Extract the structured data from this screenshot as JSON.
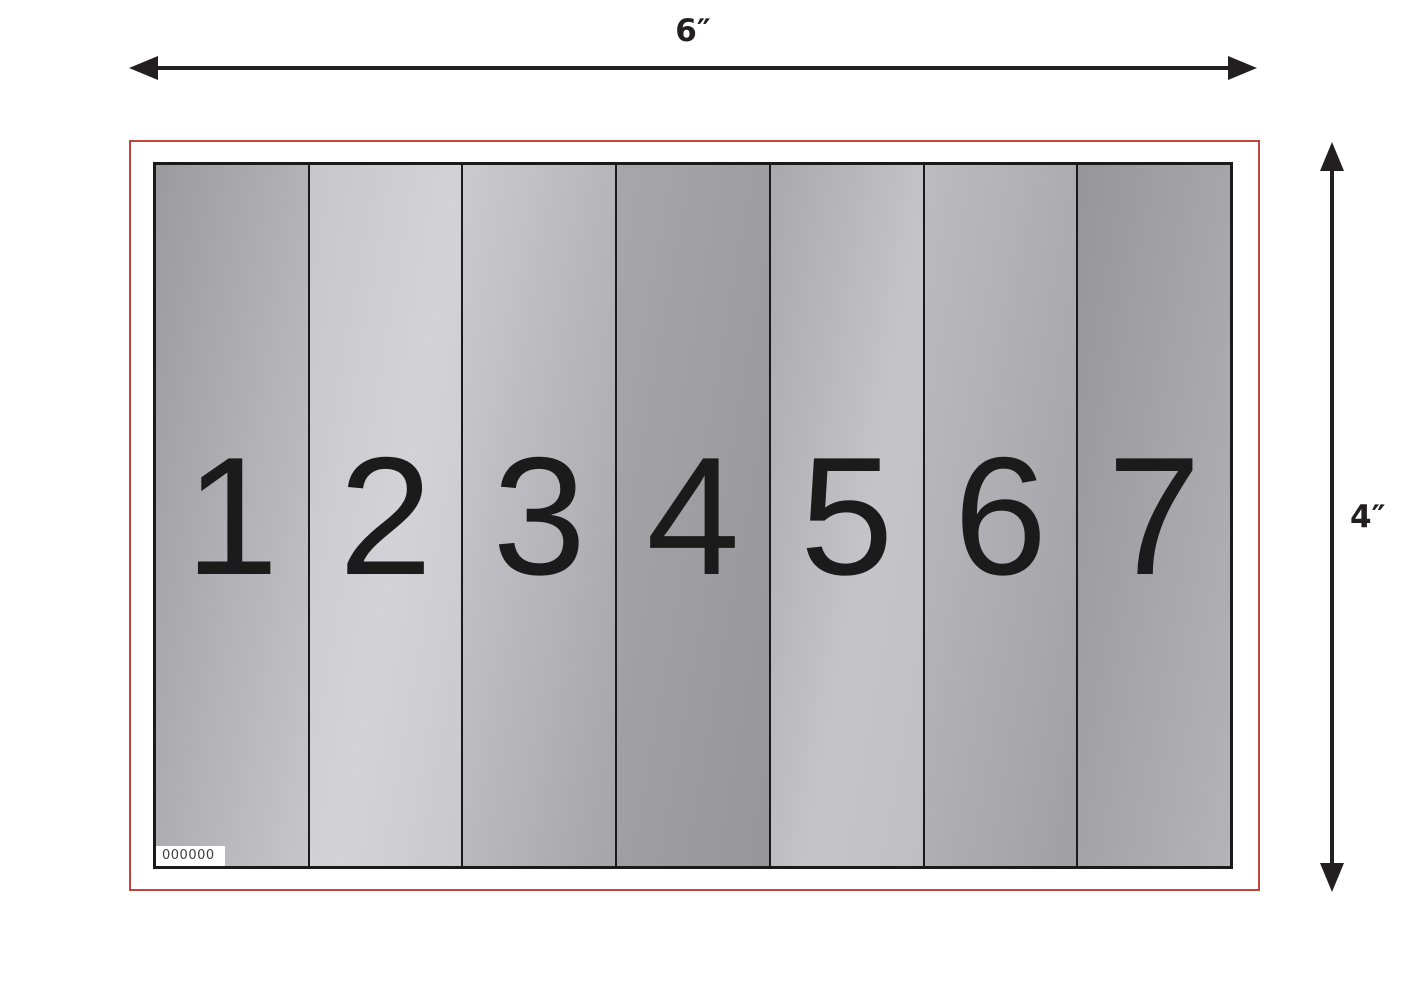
{
  "diagram": {
    "dimensions": {
      "width_label": "6″",
      "height_label": "4″"
    },
    "serial_number": "000000",
    "panels": [
      {
        "number": "1",
        "gradient": [
          "#9b9b9f 0%",
          "#c6c6ca 100%"
        ]
      },
      {
        "number": "2",
        "gradient": [
          "#c7c7cb 0%",
          "#d3d3d7 55%",
          "#c9c9cd 100%"
        ]
      },
      {
        "number": "3",
        "gradient": [
          "#cbcbcf 0%",
          "#a5a5a9 100%"
        ]
      },
      {
        "number": "4",
        "gradient": [
          "#a7a7ab 0%",
          "#96969a 100%"
        ]
      },
      {
        "number": "5",
        "gradient": [
          "#a9a9ad 0%",
          "#c5c5c9 60%",
          "#bfbfc3 100%"
        ]
      },
      {
        "number": "6",
        "gradient": [
          "#bcbcc0 0%",
          "#a0a0a4 100%"
        ]
      },
      {
        "number": "7",
        "gradient": [
          "#95959a 0%",
          "#b4b4b8 100%"
        ]
      }
    ],
    "colors": {
      "outline_red": "#c0453e",
      "line_black": "#231f20",
      "panel_border_black": "#1a1a1a",
      "digit_black": "#1b1b1b",
      "serial_text_gray": "#3d3d3d",
      "background_white": "#ffffff"
    }
  }
}
